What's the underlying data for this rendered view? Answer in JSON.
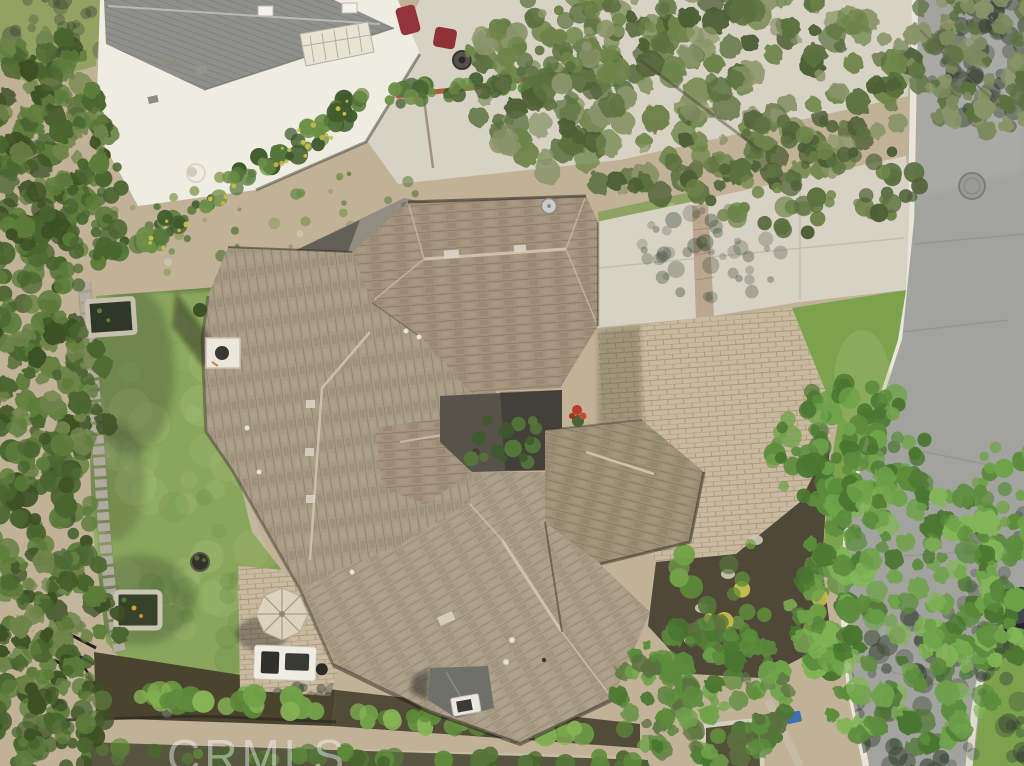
{
  "scene": {
    "description": "Aerial drone photo of a single-story tile-roof home with driveway, backyard lawn, patio umbrella, outdoor kitchen, ponds and tree-lined street"
  },
  "watermark": {
    "text": "CRMLS",
    "color": "#ffffff"
  },
  "colors": {
    "dirt": "#c0b197",
    "weed": "#8a9a5a",
    "concrete": "#d7d2c4",
    "concreteJoint": "#b9b5a7",
    "neighborWhite": "#efede2",
    "neighborRoof": "#8f8f8b",
    "trellis": "#e7e4d4",
    "brick": "#b05a3c",
    "chairRed": "#93343a",
    "road": "#a2a29e",
    "roadLight": "#b3b3af",
    "curb": "#e9e5d8",
    "crack": "#8e8e88",
    "manhole": "#9a9a96",
    "car": "#23262a",
    "lawnBack": "#8aa65c",
    "lawnFront": "#7da24e",
    "lawnLight": "#a9c17b",
    "lawnDark": "#6b8d47",
    "mulch": "#4f4738",
    "soil": "#4a442f",
    "pavers": "#c8b99f",
    "patio": "#cdbfa7",
    "pathStone": "#c3b79f",
    "roofLeft": "#a79a85",
    "roofGarage": "#a3927c",
    "roofRight": "#9e9077",
    "roofFront": "#ab9d87",
    "ridge": "#cfc2ab",
    "fascia": "#e8e2d4",
    "courtShade": "#57534b",
    "porch": "#70706a",
    "graySide": "#928d81",
    "stoneTrim": "#c6c0ae",
    "water": "#37422b",
    "wallStone": "#b3ada0",
    "umbrella": "#dcd3bd",
    "umbrellaRib": "#a89f89",
    "kitchen": "#efece2",
    "grill": "#30302b",
    "koi": "#d89b35",
    "flower": "#b83b2c",
    "blue": "#3f6fae",
    "dish": "#cbcbc8",
    "tree1": "#4d5f35",
    "tree2": "#5c7140",
    "tree3": "#6e8449",
    "tree4": "#8a9468",
    "treeG": "#7c8a5e",
    "treeL1": "#3c5124",
    "treeL2": "#4a6530",
    "treeL3": "#5d7c3b",
    "treeF1": "#4a7630",
    "treeF2": "#5c8c3c",
    "treeF3": "#6fa24a",
    "treeF4": "#82b556",
    "hedge1": "#3f5a2c",
    "hedge2": "#55763a",
    "hedge3": "#6d8f47",
    "hedgeY": "#c9bd4e",
    "shrub1": "#5e8a3a",
    "shrub2": "#72a148",
    "shrub3": "#86b356",
    "shadowBlob": "#3b4836",
    "shadowDeep": "#2e3a2a"
  }
}
